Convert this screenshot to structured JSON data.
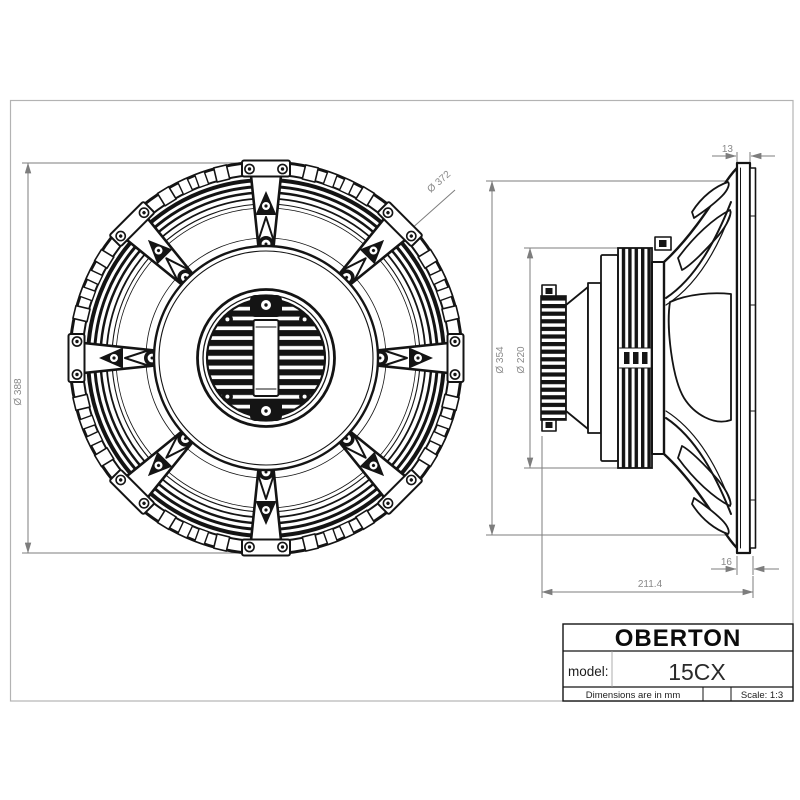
{
  "title_block": {
    "brand": "OBERTON",
    "model_label": "model:",
    "model_value": "15CX",
    "units_note": "Dimensions are in mm",
    "scale": "Scale: 1:3"
  },
  "dimensions": {
    "front_overall_diameter": "Ø 388",
    "front_bolt_circle": "Ø 372",
    "side_basket_diameter": "Ø 354",
    "side_magnet_diameter": "Ø 220",
    "side_flange_thickness": "13",
    "side_flange_gasket_thickness": "16",
    "side_total_depth": "211.4"
  },
  "colors": {
    "line": "#141414",
    "dimension": "#7d7d7d",
    "background": "#ffffff"
  }
}
